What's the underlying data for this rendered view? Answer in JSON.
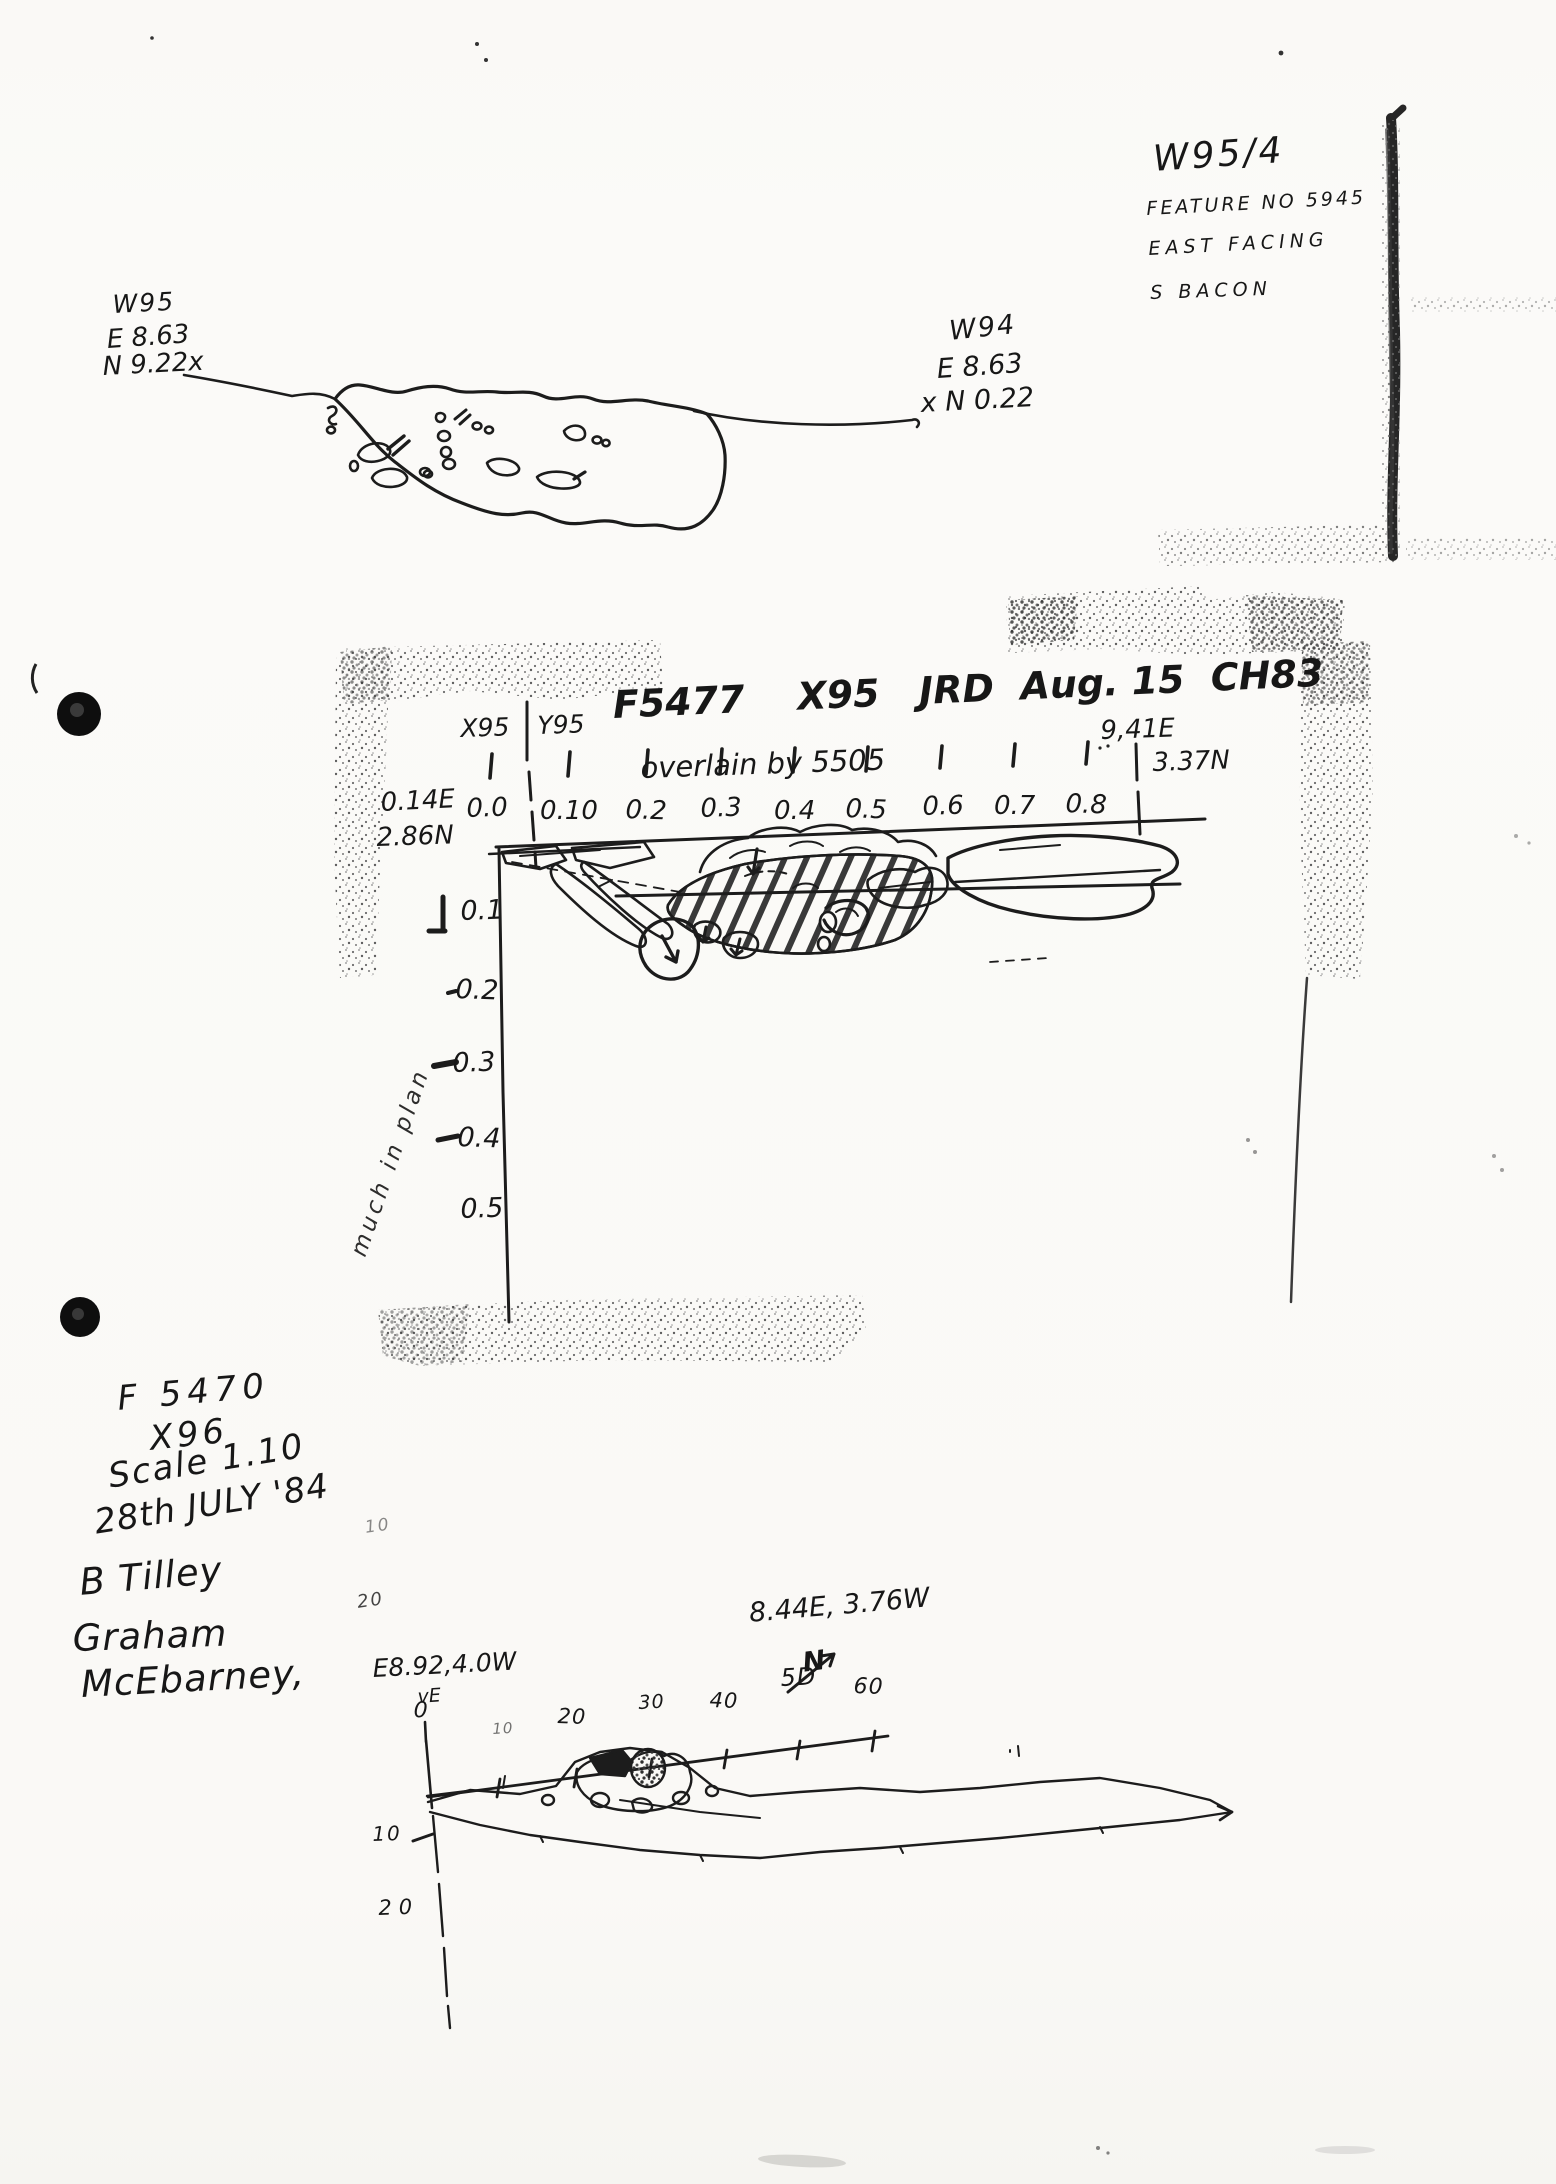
{
  "page": {
    "paper_color": "#fbfaf7",
    "ink_color": "#1b1b1b"
  },
  "top_right_note": {
    "line1": "W95/4",
    "line2": "FEATURE NO 5945",
    "line3": "EAST FACING",
    "line4": "S BACON"
  },
  "plan_left": {
    "label": "W95",
    "east": "E 8.63",
    "north": "N 9.22x"
  },
  "plan_right": {
    "label": "W94",
    "east": "E 8.63",
    "north": "x N 0.22"
  },
  "section": {
    "title": "F5477    X95   JRD  Aug. 15  CH83",
    "subtitle": "overlain by 5505",
    "col_left": "X95",
    "col_right": "Y95",
    "left_e": "0.14E",
    "left_n": "2.86N",
    "right_e": "9,41E",
    "right_n": "3.37N",
    "ruler_labels": [
      "0.0",
      "0.10",
      "0.2",
      "0.3",
      "0.4",
      "0.5",
      "0.6",
      "0.7",
      "0.8"
    ],
    "depth_labels": [
      "0.1",
      "0.2",
      "0.3",
      "0.4",
      "0.5"
    ],
    "side_note": "much in plan"
  },
  "notes": {
    "lines": [
      "F 5470",
      "X96",
      "Scale 1.10",
      "28th JULY '84",
      "B Tilley",
      "Graham",
      "McEbarney,"
    ]
  },
  "profile": {
    "coord_top": "8.44E, 3.76W",
    "compass": "N",
    "coord_left": "E8.92,4.0W",
    "ve": "vE",
    "x_labels": [
      "0",
      "10",
      "20",
      "30",
      "40",
      "5D",
      "60"
    ],
    "y_labels": [
      "10",
      "20"
    ],
    "faint_labels": [
      "10",
      "20"
    ]
  }
}
